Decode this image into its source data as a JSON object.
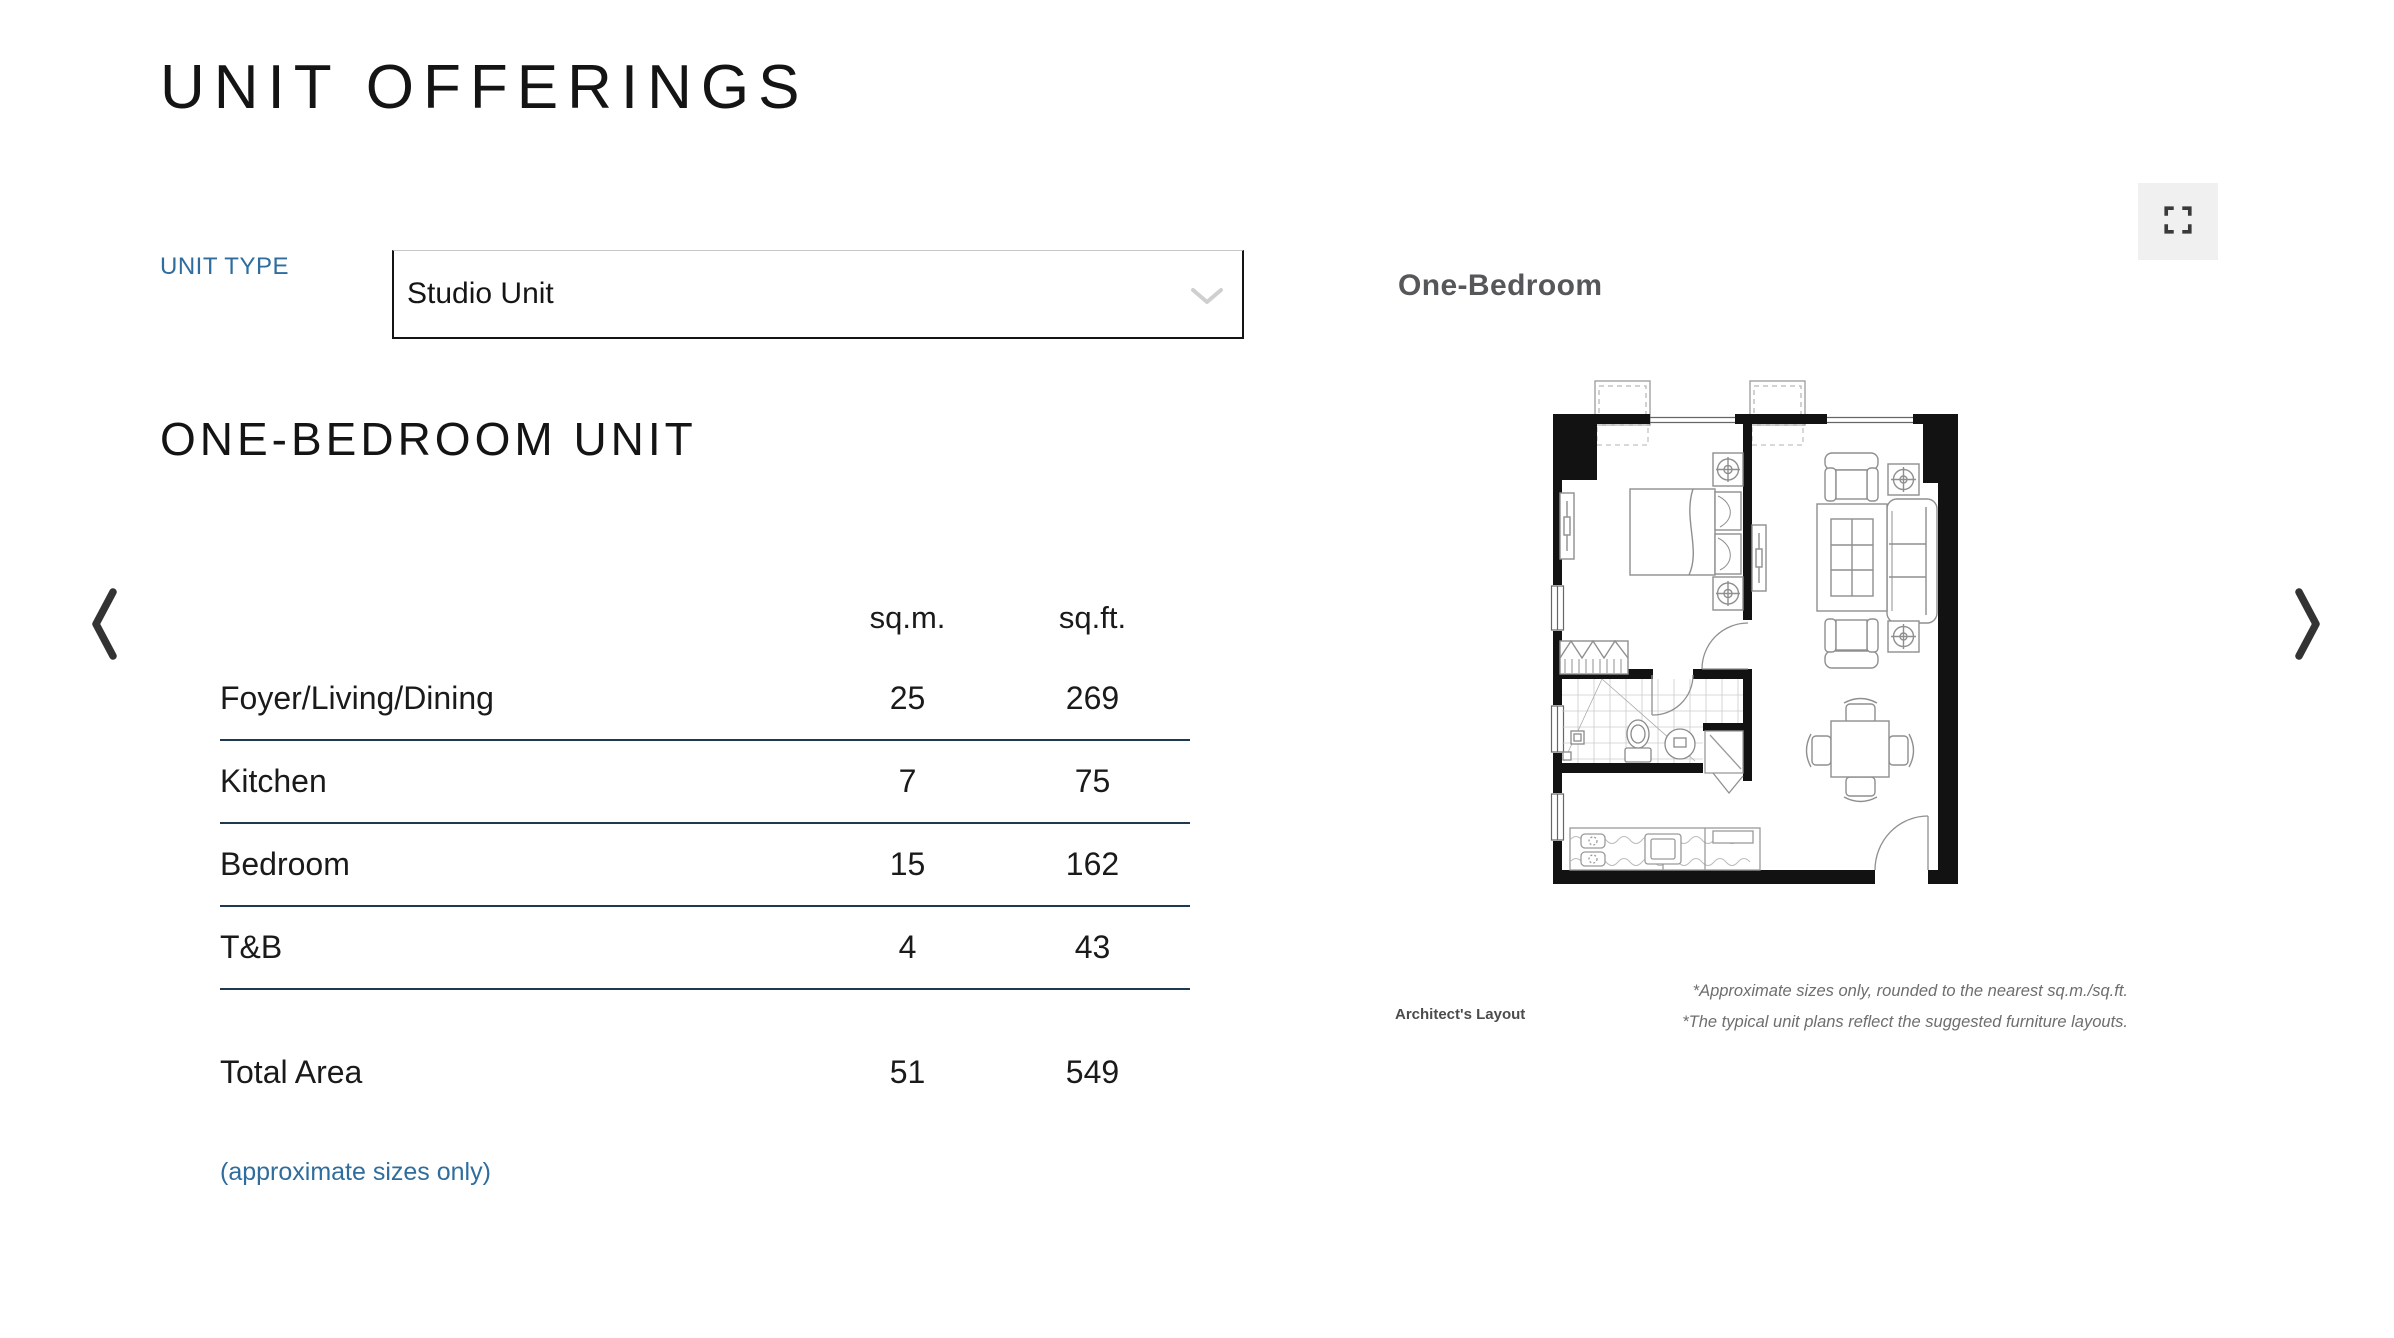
{
  "header": {
    "title": "UNIT OFFERINGS"
  },
  "unit_type": {
    "label": "UNIT TYPE",
    "selected_option": "Studio Unit"
  },
  "section_heading": "ONE-BEDROOM UNIT",
  "area_table": {
    "col_sqm": "sq.m.",
    "col_sqft": "sq.ft.",
    "rows": [
      {
        "label": "Foyer/Living/Dining",
        "sqm": "25",
        "sqft": "269"
      },
      {
        "label": "Kitchen",
        "sqm": "7",
        "sqft": "75"
      },
      {
        "label": "Bedroom",
        "sqm": "15",
        "sqft": "162"
      },
      {
        "label": "T&B",
        "sqm": "4",
        "sqft": "43"
      }
    ],
    "total_label": "Total Area",
    "total_sqm": "51",
    "total_sqft": "549",
    "note": "(approximate sizes only)"
  },
  "floorplan": {
    "title": "One-Bedroom",
    "architect_label": "Architect's Layout",
    "disclaimers": [
      "*Approximate sizes only, rounded to the nearest sq.m./sq.ft.",
      "*The typical unit plans reflect the suggested furniture layouts."
    ]
  },
  "colors": {
    "accent_blue": "#2e6d9e",
    "divider_navy": "#1d3a52",
    "heading_text": "#141414",
    "plan_text_gray": "#56575a",
    "fullscreen_bg": "#f0f0f0"
  }
}
